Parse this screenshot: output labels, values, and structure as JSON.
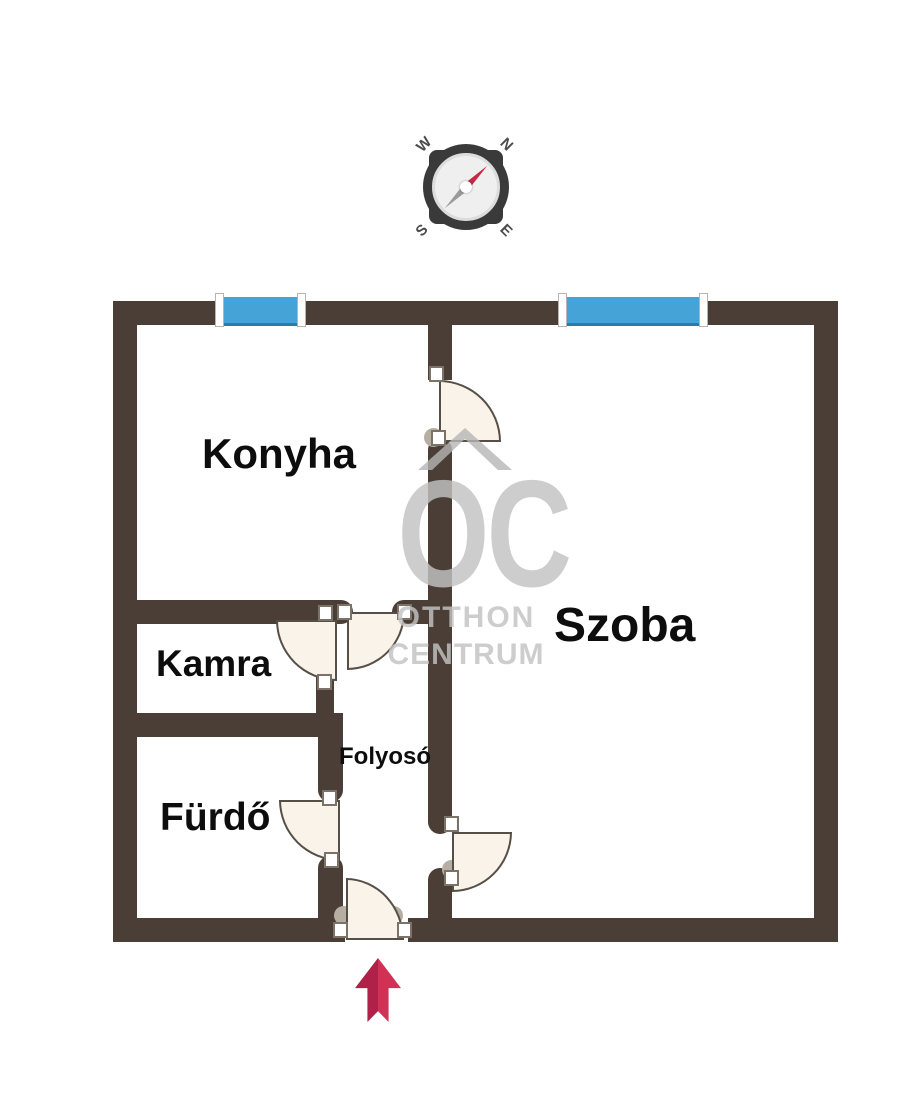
{
  "title": "apartment-floor-plan",
  "rooms": [
    {
      "id": "konyha",
      "label": "Konyha"
    },
    {
      "id": "szoba",
      "label": "Szoba"
    },
    {
      "id": "kamra",
      "label": "Kamra"
    },
    {
      "id": "folyoso",
      "label": "Folyosó"
    },
    {
      "id": "furdo",
      "label": "Fürdő"
    }
  ],
  "watermark": {
    "initials": "OC",
    "line1": "OTTHON",
    "line2": "CENTRUM"
  },
  "compass": {
    "n": "N",
    "e": "E",
    "s": "S",
    "w": "W"
  },
  "colors": {
    "wall": "#4a3e36",
    "window-blue": "#45a3d7",
    "window-edge": "#2e7ba8",
    "door-fill": "#faf3ea",
    "door-line": "#564f48",
    "label": "#0d0d0d",
    "watermark-gray": "#c3c3c3",
    "chevron-gray": "#b5b5b5",
    "arrow-red": "#d23156",
    "arrow-red-dark": "#af2148",
    "compass-dark": "#3a3a3a",
    "needle-red": "#c62846",
    "needle-gray": "#9a9a9a",
    "hinge-dot": "#b7aea3"
  }
}
